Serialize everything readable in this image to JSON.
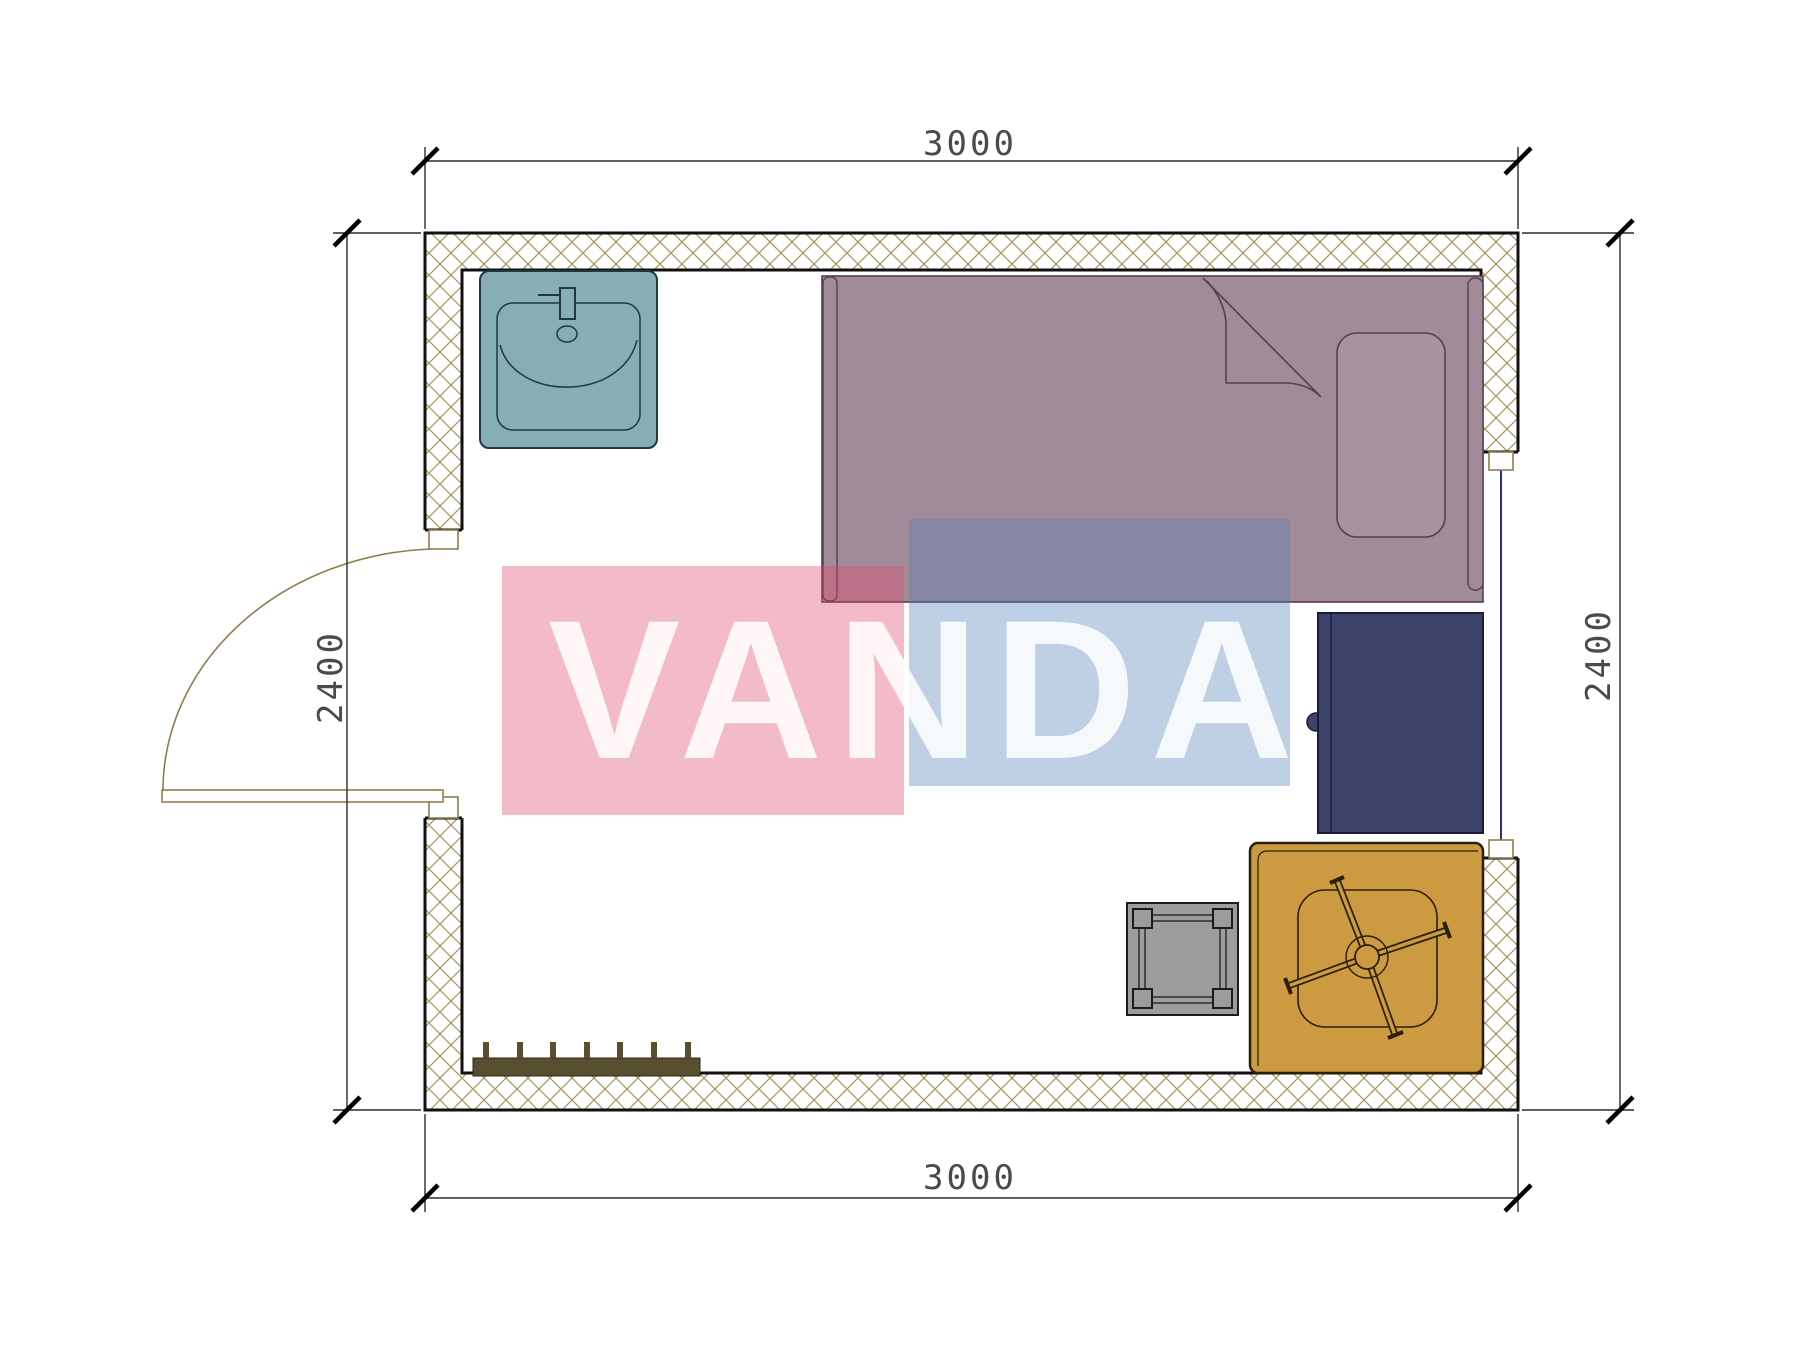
{
  "title": "Cabin floor plan 3000 x 2400 with furniture",
  "watermark": {
    "text": "VANDA"
  },
  "dimensions": {
    "top": "3000",
    "bottom": "3000",
    "left": "2400",
    "right": "2400"
  },
  "room": {
    "width_mm": 3000,
    "depth_mm": 2400
  },
  "openings": [
    {
      "name": "swing-door",
      "wall": "left",
      "state": "open-90deg"
    },
    {
      "name": "window",
      "wall": "right"
    }
  ],
  "furniture": [
    {
      "name": "sink",
      "color": "#86aeb4"
    },
    {
      "name": "single-bed",
      "color": "#a28b98"
    },
    {
      "name": "pillow",
      "color": "#a8929f"
    },
    {
      "name": "blanket-fold",
      "color": "#53404f"
    },
    {
      "name": "wardrobe",
      "color": "#3c4269"
    },
    {
      "name": "desk-with-office-chair",
      "color": "#cc9b41"
    },
    {
      "name": "stool",
      "color": "#9d9d9d"
    },
    {
      "name": "radiator",
      "color": "#584f31"
    }
  ],
  "colors": {
    "wall_hatch": "#a6945e",
    "wall_outline": "#111111",
    "dimension_line": "#2a2a2a",
    "door_line": "#8f7d4a",
    "window_line": "#2b2e8c",
    "watermark_pink": "rgba(222,71,106,0.37)",
    "watermark_blue": "rgba(82,128,182,0.37)",
    "watermark_text": "rgba(255,255,255,0.86)"
  }
}
